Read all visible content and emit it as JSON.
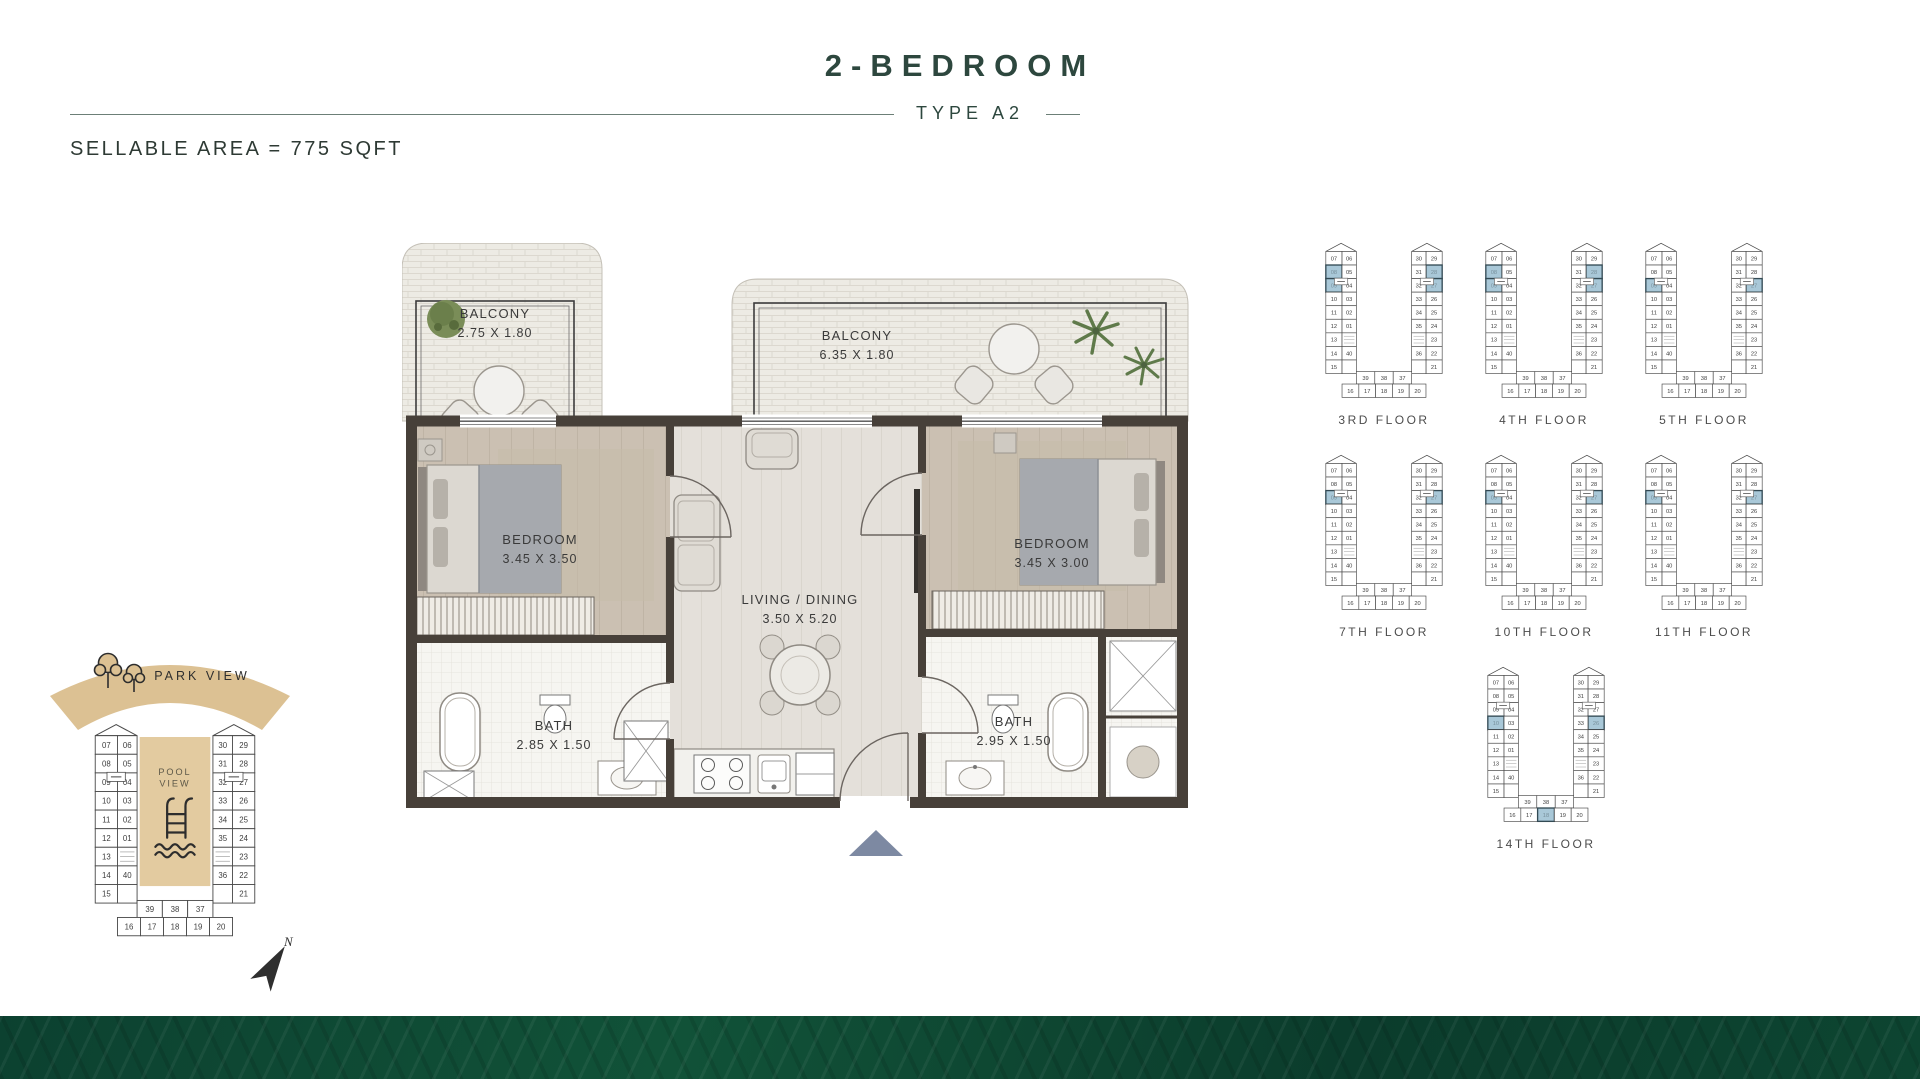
{
  "header": {
    "title": "2-BEDROOM",
    "subtitle": "TYPE A2",
    "sellable": "SELLABLE AREA = 775 SQFT"
  },
  "plan": {
    "balcony_left": {
      "name": "BALCONY",
      "dims": "2.75 X 1.80"
    },
    "balcony_main": {
      "name": "BALCONY",
      "dims": "6.35 X 1.80"
    },
    "bedroom_left": {
      "name": "BEDROOM",
      "dims": "3.45 X 3.50"
    },
    "living": {
      "name": "LIVING / DINING",
      "dims": "3.50 X 5.20"
    },
    "bedroom_right": {
      "name": "BEDROOM",
      "dims": "3.45 X 3.00"
    },
    "bath_left": {
      "name": "BATH",
      "dims": "2.85 X 1.50"
    },
    "bath_right": {
      "name": "BATH",
      "dims": "2.95 X 1.50"
    }
  },
  "key_plan": {
    "park_label": "PARK VIEW",
    "pool_label": "POOL VIEW",
    "north_label": "N"
  },
  "building": {
    "left_outer": [
      "07",
      "08",
      "09",
      "10",
      "11",
      "12",
      "13",
      "14",
      "15"
    ],
    "left_inner": [
      "06",
      "05",
      "04",
      "03",
      "02",
      "01",
      "40"
    ],
    "right_inner": [
      "30",
      "31",
      "32",
      "33",
      "34",
      "35",
      "36"
    ],
    "right_outer": [
      "29",
      "28",
      "27",
      "26",
      "25",
      "24",
      "23",
      "22",
      "21"
    ],
    "bottom_inner": [
      "39",
      "38",
      "37"
    ],
    "bottom_outer": [
      "16",
      "17",
      "18",
      "19",
      "20"
    ]
  },
  "floors": [
    {
      "label": "3RD FLOOR",
      "highlights": [
        "08",
        "09",
        "28",
        "27"
      ]
    },
    {
      "label": "4TH FLOOR",
      "highlights": [
        "08",
        "09",
        "28",
        "27"
      ]
    },
    {
      "label": "5TH FLOOR",
      "highlights": [
        "09",
        "27"
      ]
    },
    {
      "label": "7TH FLOOR",
      "highlights": [
        "09",
        "27"
      ]
    },
    {
      "label": "10TH FLOOR",
      "highlights": [
        "09",
        "27"
      ]
    },
    {
      "label": "11TH FLOOR",
      "highlights": [
        "09",
        "27"
      ]
    },
    {
      "label": "14TH FLOOR",
      "highlights": [
        "10",
        "26",
        "18"
      ]
    }
  ],
  "colors": {
    "accent_green": "#2d473e",
    "arc_tan": "#dcc193",
    "pool_tan": "#e3cba0",
    "highlight_blue": "#a9c8d8",
    "wall": "#474039",
    "band_green": "#0c4130",
    "entry_arrow": "#7d89a2"
  }
}
